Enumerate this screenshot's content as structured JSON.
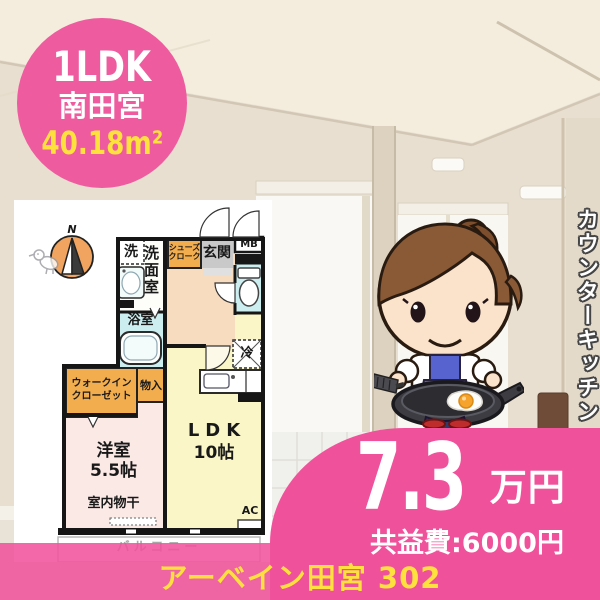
{
  "badge": {
    "layout": "1LDK",
    "location": "南田宮",
    "area": "40.18m²"
  },
  "caption": {
    "vertical": "カウンターキッチン"
  },
  "price": {
    "rent": "7.3",
    "rent_unit": "万円",
    "common_fee": "共益費:6000円"
  },
  "footer": {
    "property": "アーベイン田宮 302"
  },
  "floorplan": {
    "compass": "N",
    "labels": {
      "laundry": "洗",
      "washroom": "洗面室",
      "shoe_closet_1": "シューズ",
      "shoe_closet_2": "クローク",
      "entrance": "玄関",
      "meter_box": "MB",
      "bathroom": "浴室",
      "fridge": "冷",
      "wic_1": "ウォークイン",
      "wic_2": "クローゼット",
      "storage": "物入",
      "western_room": "洋室",
      "western_room_size": "5.5帖",
      "ldk": "LDK",
      "ldk_size": "10帖",
      "indoor_drying": "室内物干",
      "ac": "AC",
      "balcony": "バルコニー"
    }
  },
  "colors": {
    "brand_pink": "#f0519b",
    "accent_yellow": "#ffe13e",
    "plan_orange": "#f2ae4e",
    "plan_cyan": "#cdeef0",
    "plan_peach": "#f7dcc0",
    "plan_yellow": "#faf6c8",
    "plan_pink": "#fbe9e6",
    "wall_black": "#161616"
  }
}
